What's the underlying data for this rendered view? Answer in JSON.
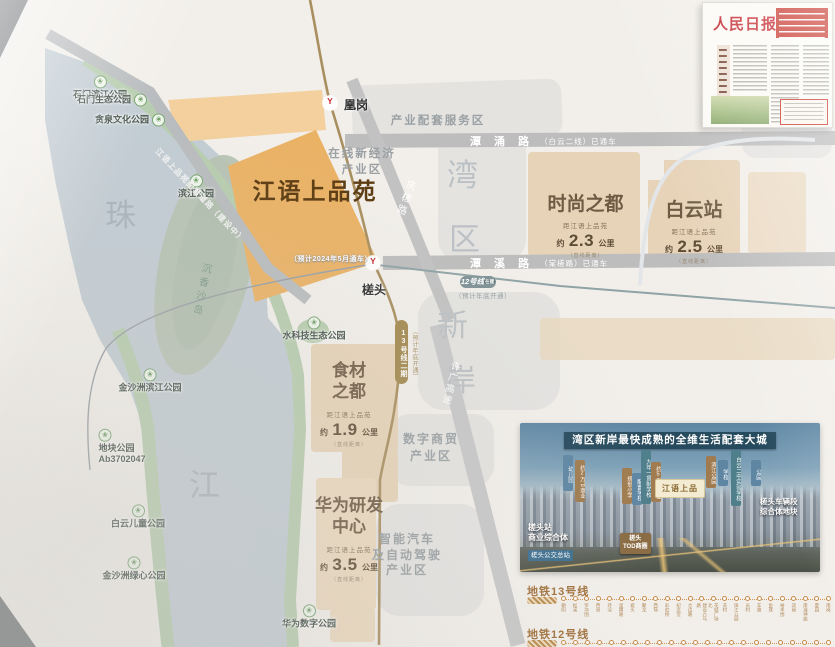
{
  "map": {
    "project": {
      "name": "江语上品苑"
    },
    "big": {
      "zhu": "珠",
      "jiang": "江",
      "wan": "湾",
      "qu": "区",
      "xin": "新",
      "an": "岸",
      "island": "沉香沙岛"
    },
    "parks": [
      "石门滨江公园",
      "石门生态公园",
      "贪泉文化公园",
      "滨江公园",
      "金沙洲滨江公园",
      "地块公园\nAb3702047",
      "白云儿童公园",
      "金沙洲绿心公园",
      "水科技生态公园",
      "华为数字公园"
    ],
    "zones": {
      "fuwu": "产业配套服务区",
      "zaixian": "在线新经济\n产业区",
      "shuzi": "数字商贸\n产业区",
      "zhineng": "智能汽车\n及自动驾驶\n产业区"
    },
    "roads": {
      "tanyong_name": "潭 涌 路",
      "tanyong_note": "（白云二线）已通车",
      "tanxi_name": "潭 溪 路",
      "tanxi_note": "（棠槎路）已通车",
      "qingcha": "庆槎路",
      "xuguang": "许广高速",
      "peitao": "江语上品苑配套道路（建设中）"
    },
    "metro": {
      "station_huanggang": "凰岗",
      "station_chatou": "槎头",
      "chatou_note": "（预计2024年5月通车）",
      "line12_badge": "12号线",
      "line12_tag": "在建",
      "line12_note": "（预计年底开通）",
      "line13_badge": "13号线二期",
      "line13_note": "（预计年底开通）",
      "logo_glyph": "Y"
    },
    "poi": {
      "fashion": {
        "name": "时尚之都",
        "dist_prefix": "距江语上品苑",
        "approx": "约",
        "value": "2.3",
        "unit": "公里",
        "note": "（直线距离）"
      },
      "baiyun": {
        "name": "白云站",
        "dist_prefix": "距江语上品苑",
        "approx": "约",
        "value": "2.5",
        "unit": "公里",
        "note": "（直线距离）"
      },
      "food": {
        "name": "食材\n之都",
        "dist_prefix": "距江语上品苑",
        "approx": "约",
        "value": "1.9",
        "unit": "公里",
        "note": "（直线距离）"
      },
      "huawei": {
        "name": "华为研发\n中心",
        "dist_prefix": "距江语上品苑",
        "approx": "约",
        "value": "3.5",
        "unit": "公里",
        "note": "（直线距离）"
      }
    }
  },
  "newspaper": {
    "masthead": "人民日报"
  },
  "panel": {
    "title": "湾区新岸最快成熟的全维生活配套大城",
    "logo": "江语上品",
    "left_label": "槎头站\n商业综合体",
    "left_tag": "槎头公交总站",
    "right_label": "槎头车辆段\n综合体地块",
    "center_tag": "槎头\nTOD商圈",
    "flags": [
      "幼儿园",
      "约2万㎡商业",
      "规划小学",
      "配套学校",
      "九年一贯制学校",
      "约5万㎡商业",
      "滨江公园",
      "学校",
      "白云二中实验学校",
      "公园"
    ]
  },
  "metro_diagram": {
    "line13_title": "地铁13号线",
    "line12_title": "地铁12号线",
    "line13_stations": [
      "朝阳",
      "松溪",
      "罗冲围",
      "西洲",
      "环滘",
      "里横路",
      "槎头",
      "聚龙",
      "西场",
      "彩虹桥",
      "纪念堂",
      "仓边路",
      "建设六马路",
      "花城广场北",
      "冼村",
      "珠江公园",
      "员村",
      "车陂",
      "鱼珠",
      "裕丰围",
      "双岗",
      "南海神庙",
      "夏园",
      "南岗"
    ],
    "line12_dots": [
      "",
      "",
      "",
      "",
      "",
      "",
      "",
      "",
      "",
      "",
      "",
      "",
      "",
      "",
      "",
      "",
      "",
      "",
      "",
      "",
      "",
      "",
      ""
    ]
  }
}
